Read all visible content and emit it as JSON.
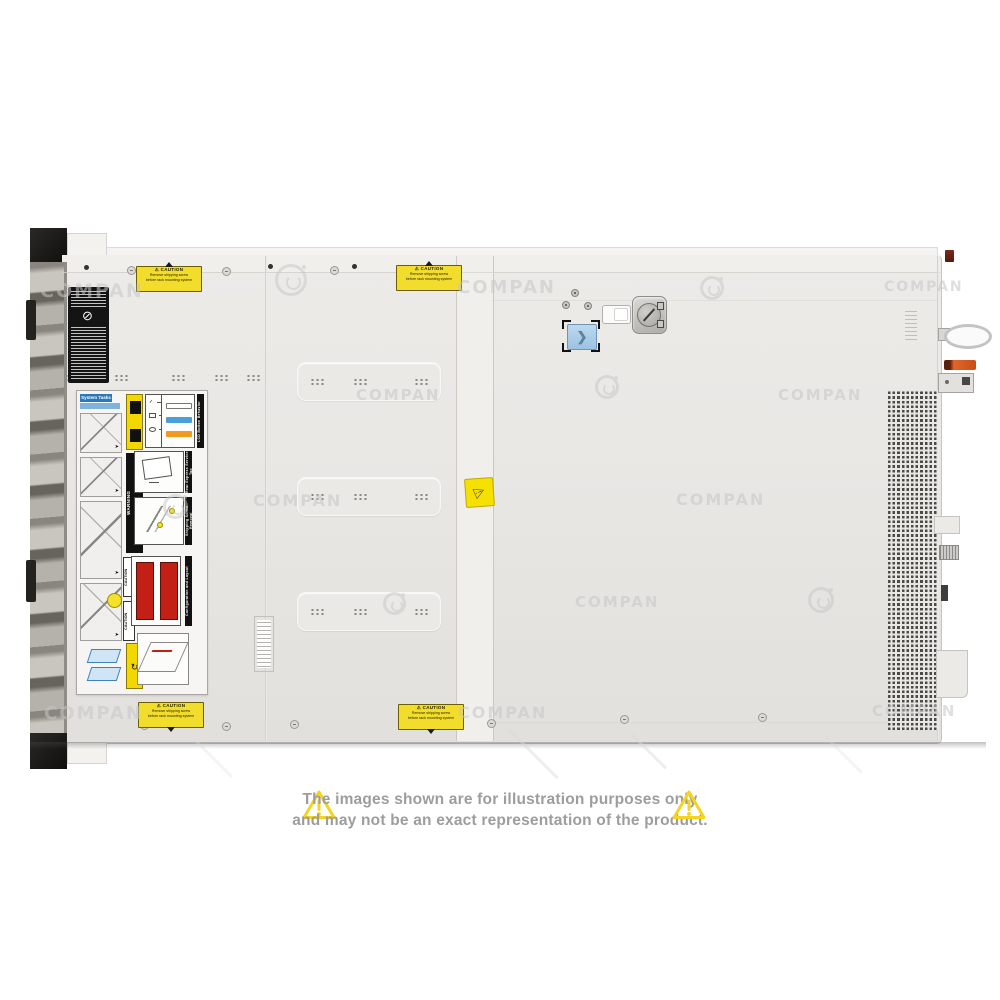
{
  "watermark": {
    "text": "COMPAN",
    "color": "#c6c6c6",
    "logo": "g-mark"
  },
  "icons": {
    "warning": "⚠",
    "chevron": "❯",
    "rotate": "↻",
    "no_symbol": "⊘",
    "check": "✓"
  },
  "disclaimer": {
    "line1": "The images shown are for illustration purposes only",
    "line2": "and may not be an exact representation of the product.",
    "text_color": "#9d9d9d",
    "triangle_color": "#f6d31d"
  },
  "server": {
    "description": "top view of rack server chassis",
    "caution_label": {
      "title": "CAUTION",
      "line1": "Remove shipping screw",
      "line2": "before rack mounting system",
      "bg": "#f2dc2c"
    },
    "service_label": {
      "header": "System Tasks",
      "sections": {
        "warning": "WARNING",
        "caution": "CAUTION",
        "icon_legend": "Icon Legend",
        "lcd": "LCD Button Behavior",
        "rear_tag": "Rear Express Service Tag",
        "shipping": "Shipping Screw Removal",
        "config": "Configuration and Layout"
      },
      "lcd_bar_colors": [
        "#ffffff",
        "#4a9fd8",
        "#f09a20"
      ],
      "drive_grid_color": "#c22014"
    },
    "colors": {
      "chassis": "#e9e7e4",
      "release_button": "#a9cbe7",
      "lever_orange": "#d85a1f",
      "vent_dark": "#4c4a46"
    }
  }
}
